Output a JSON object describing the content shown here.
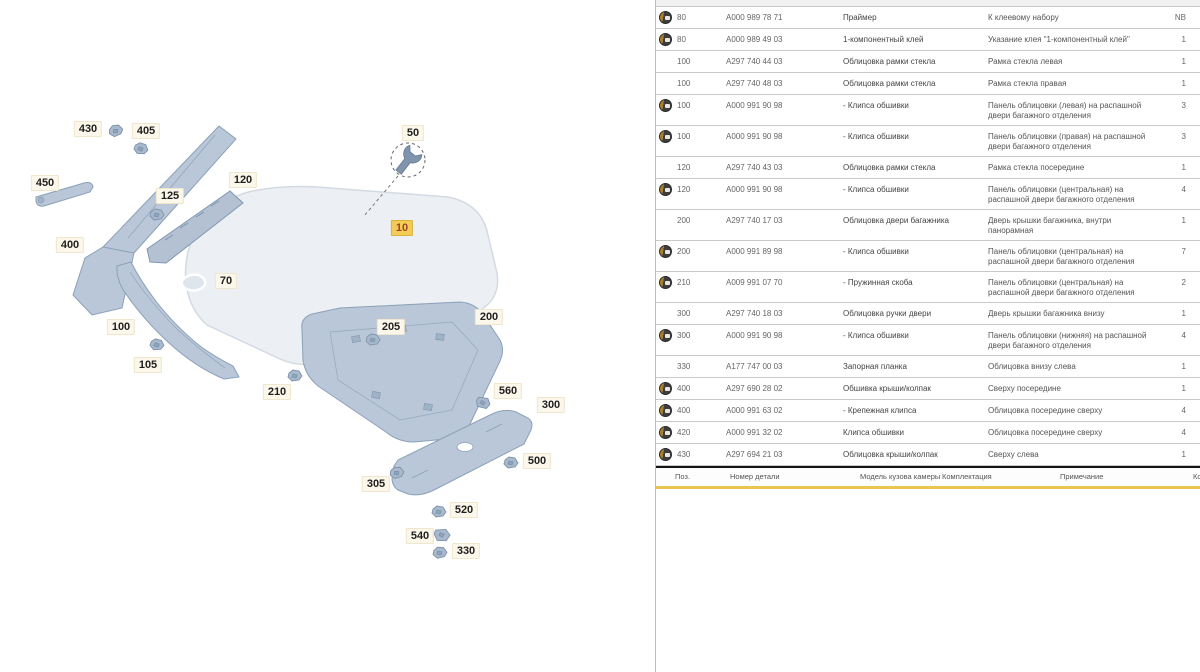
{
  "app": {
    "kind": "parts-catalog",
    "accent_yellow": "#e9c64f",
    "selected_label_bg": "#f2cd55"
  },
  "diagram": {
    "selected_callout": "10",
    "wrench_callout": "50",
    "callouts": [
      {
        "text": "430",
        "x": 88,
        "y": 129,
        "selected": false
      },
      {
        "text": "405",
        "x": 146,
        "y": 131,
        "selected": false
      },
      {
        "text": "450",
        "x": 45,
        "y": 183,
        "selected": false
      },
      {
        "text": "125",
        "x": 170,
        "y": 196,
        "selected": false
      },
      {
        "text": "120",
        "x": 243,
        "y": 180,
        "selected": false
      },
      {
        "text": "400",
        "x": 70,
        "y": 245,
        "selected": false
      },
      {
        "text": "70",
        "x": 226,
        "y": 281,
        "selected": false
      },
      {
        "text": "100",
        "x": 121,
        "y": 327,
        "selected": false
      },
      {
        "text": "105",
        "x": 148,
        "y": 365,
        "selected": false
      },
      {
        "text": "50",
        "x": 413,
        "y": 133,
        "selected": false
      },
      {
        "text": "10",
        "x": 402,
        "y": 228,
        "selected": true
      },
      {
        "text": "205",
        "x": 391,
        "y": 327,
        "selected": false
      },
      {
        "text": "200",
        "x": 489,
        "y": 317,
        "selected": false
      },
      {
        "text": "210",
        "x": 277,
        "y": 392,
        "selected": false
      },
      {
        "text": "560",
        "x": 508,
        "y": 391,
        "selected": false
      },
      {
        "text": "300",
        "x": 551,
        "y": 405,
        "selected": false
      },
      {
        "text": "500",
        "x": 537,
        "y": 461,
        "selected": false
      },
      {
        "text": "305",
        "x": 376,
        "y": 484,
        "selected": false
      },
      {
        "text": "520",
        "x": 464,
        "y": 510,
        "selected": false
      },
      {
        "text": "540",
        "x": 420,
        "y": 536,
        "selected": false
      },
      {
        "text": "330",
        "x": 466,
        "y": 551,
        "selected": false
      }
    ]
  },
  "table": {
    "columns": [
      {
        "label": "Поз.",
        "x": 19
      },
      {
        "label": "Номер детали",
        "x": 74
      },
      {
        "label": "Модель кузова камеры",
        "x": 204
      },
      {
        "label": "Комплектация",
        "x": 286
      },
      {
        "label": "Примечание",
        "x": 404
      },
      {
        "label": "Количество",
        "x": 537
      }
    ],
    "rows": [
      {
        "badge": true,
        "pos": "80",
        "pn": "A000 989 78 71",
        "desc": "Праймер",
        "note": "К клеевому набору",
        "qty": "NB"
      },
      {
        "badge": true,
        "pos": "80",
        "pn": "A000 989 49 03",
        "desc": "1-компонентный клей",
        "note": "Указание клея \"1-компонентный клей\"",
        "qty": "1"
      },
      {
        "badge": false,
        "pos": "100",
        "pn": "A297 740 44 03",
        "desc": "Облицовка рамки стекла",
        "note": "Рамка стекла левая",
        "qty": "1"
      },
      {
        "badge": false,
        "pos": "100",
        "pn": "A297 740 48 03",
        "desc": "Облицовка рамки стекла",
        "note": "Рамка стекла правая",
        "qty": "1"
      },
      {
        "badge": true,
        "pos": "100",
        "pn": "A000 991 90 98",
        "desc": "- Клипса обшивки",
        "note": "Панель облицовки (левая) на распашной двери багажного отделения",
        "qty": "3"
      },
      {
        "badge": true,
        "pos": "100",
        "pn": "A000 991 90 98",
        "desc": "- Клипса обшивки",
        "note": "Панель облицовки (правая) на распашной двери багажного отделения",
        "qty": "3"
      },
      {
        "badge": false,
        "pos": "120",
        "pn": "A297 740 43 03",
        "desc": "Облицовка рамки стекла",
        "note": "Рамка стекла посередине",
        "qty": "1"
      },
      {
        "badge": true,
        "pos": "120",
        "pn": "A000 991 90 98",
        "desc": "- Клипса обшивки",
        "note": "Панель облицовки (центральная) на распашной двери багажного отделения",
        "qty": "4"
      },
      {
        "badge": false,
        "pos": "200",
        "pn": "A297 740 17 03",
        "desc": "Облицовка двери багажника",
        "note": "Дверь крышки багажника, внутри панорамная",
        "qty": "1"
      },
      {
        "badge": true,
        "pos": "200",
        "pn": "A000 991 89 98",
        "desc": "- Клипса обшивки",
        "note": "Панель облицовки (центральная) на распашной двери багажного отделения",
        "qty": "7"
      },
      {
        "badge": true,
        "pos": "210",
        "pn": "A009 991 07 70",
        "desc": "- Пружинная скоба",
        "note": "Панель облицовки (центральная) на распашной двери багажного отделения",
        "qty": "2"
      },
      {
        "badge": false,
        "pos": "300",
        "pn": "A297 740 18 03",
        "desc": "Облицовка ручки двери",
        "note": "Дверь крышки багажника внизу",
        "qty": "1"
      },
      {
        "badge": true,
        "pos": "300",
        "pn": "A000 991 90 98",
        "desc": "- Клипса обшивки",
        "note": "Панель облицовки (нижняя) на распашной двери багажного отделения",
        "qty": "4"
      },
      {
        "badge": false,
        "pos": "330",
        "pn": "A177 747 00 03",
        "desc": "Запорная планка",
        "note": "Облицовка внизу слева",
        "qty": "1"
      },
      {
        "badge": true,
        "pos": "400",
        "pn": "A297 690 28 02",
        "desc": "Обшивка крыши/колпак",
        "note": "Сверху посередине",
        "qty": "1"
      },
      {
        "badge": true,
        "pos": "400",
        "pn": "A000 991 63 02",
        "desc": "- Крепежная клипса",
        "note": "Облицовка посередине сверху",
        "qty": "4"
      },
      {
        "badge": true,
        "pos": "420",
        "pn": "A000 991 32 02",
        "desc": "Клипса обшивки",
        "note": "Облицовка посередине сверху",
        "qty": "4"
      },
      {
        "badge": true,
        "pos": "430",
        "pn": "A297 694 21 03",
        "desc": "Облицовка крыши/колпак",
        "note": "Сверху слева",
        "qty": "1"
      }
    ]
  }
}
